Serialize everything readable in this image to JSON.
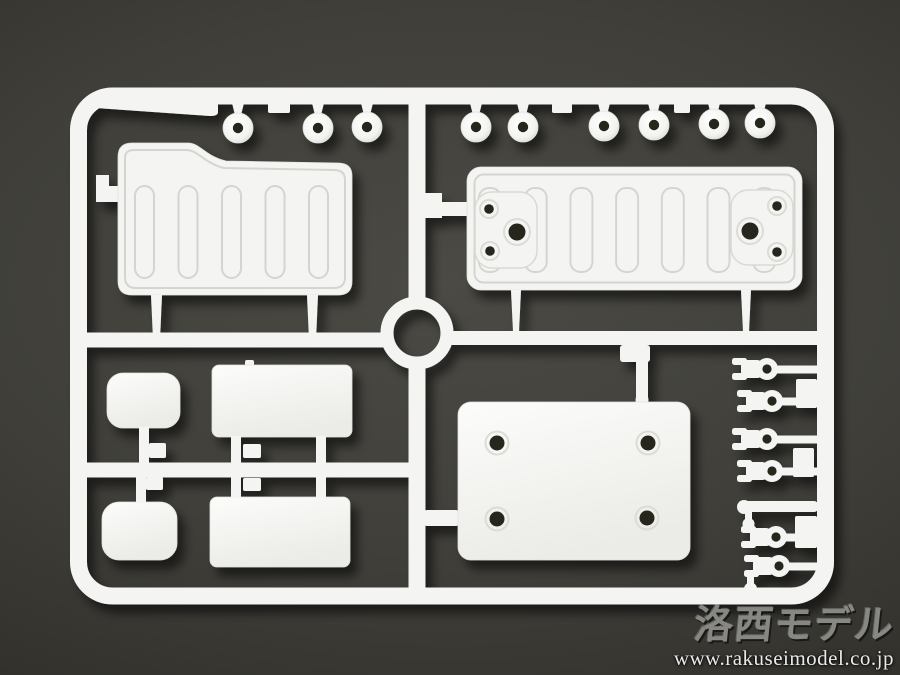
{
  "image": {
    "type": "product-photo",
    "subject": "White plastic model-kit parts sprue (runner) on a dark gray background"
  },
  "watermark": {
    "logo_text": "洛西モデル",
    "url_text": "www.rakuseimodel.co.jp"
  },
  "sprue": {
    "plastic_color": "white",
    "parts_visible": [
      {
        "name": "round-bushing",
        "count": 9
      },
      {
        "name": "stepped-ribbed-panel",
        "count": 1
      },
      {
        "name": "ribbed-panel-with-mount-holes",
        "count": 1
      },
      {
        "name": "small-rounded-pad",
        "count": 2
      },
      {
        "name": "rectangular-plate",
        "count": 2
      },
      {
        "name": "four-hole-base-plate",
        "count": 1
      },
      {
        "name": "fork-clip",
        "count": 6
      },
      {
        "name": "molding-tag",
        "count": 1
      },
      {
        "name": "center-ring",
        "count": 1
      }
    ]
  },
  "colors": {
    "background_center": "#4b4a44",
    "background_edge": "#181714",
    "plastic": "#f4f4f2",
    "plastic_edge_line": "#d5d5d0",
    "watermark_logo": "#8e8e8b",
    "watermark_url": "#eaeae8"
  }
}
